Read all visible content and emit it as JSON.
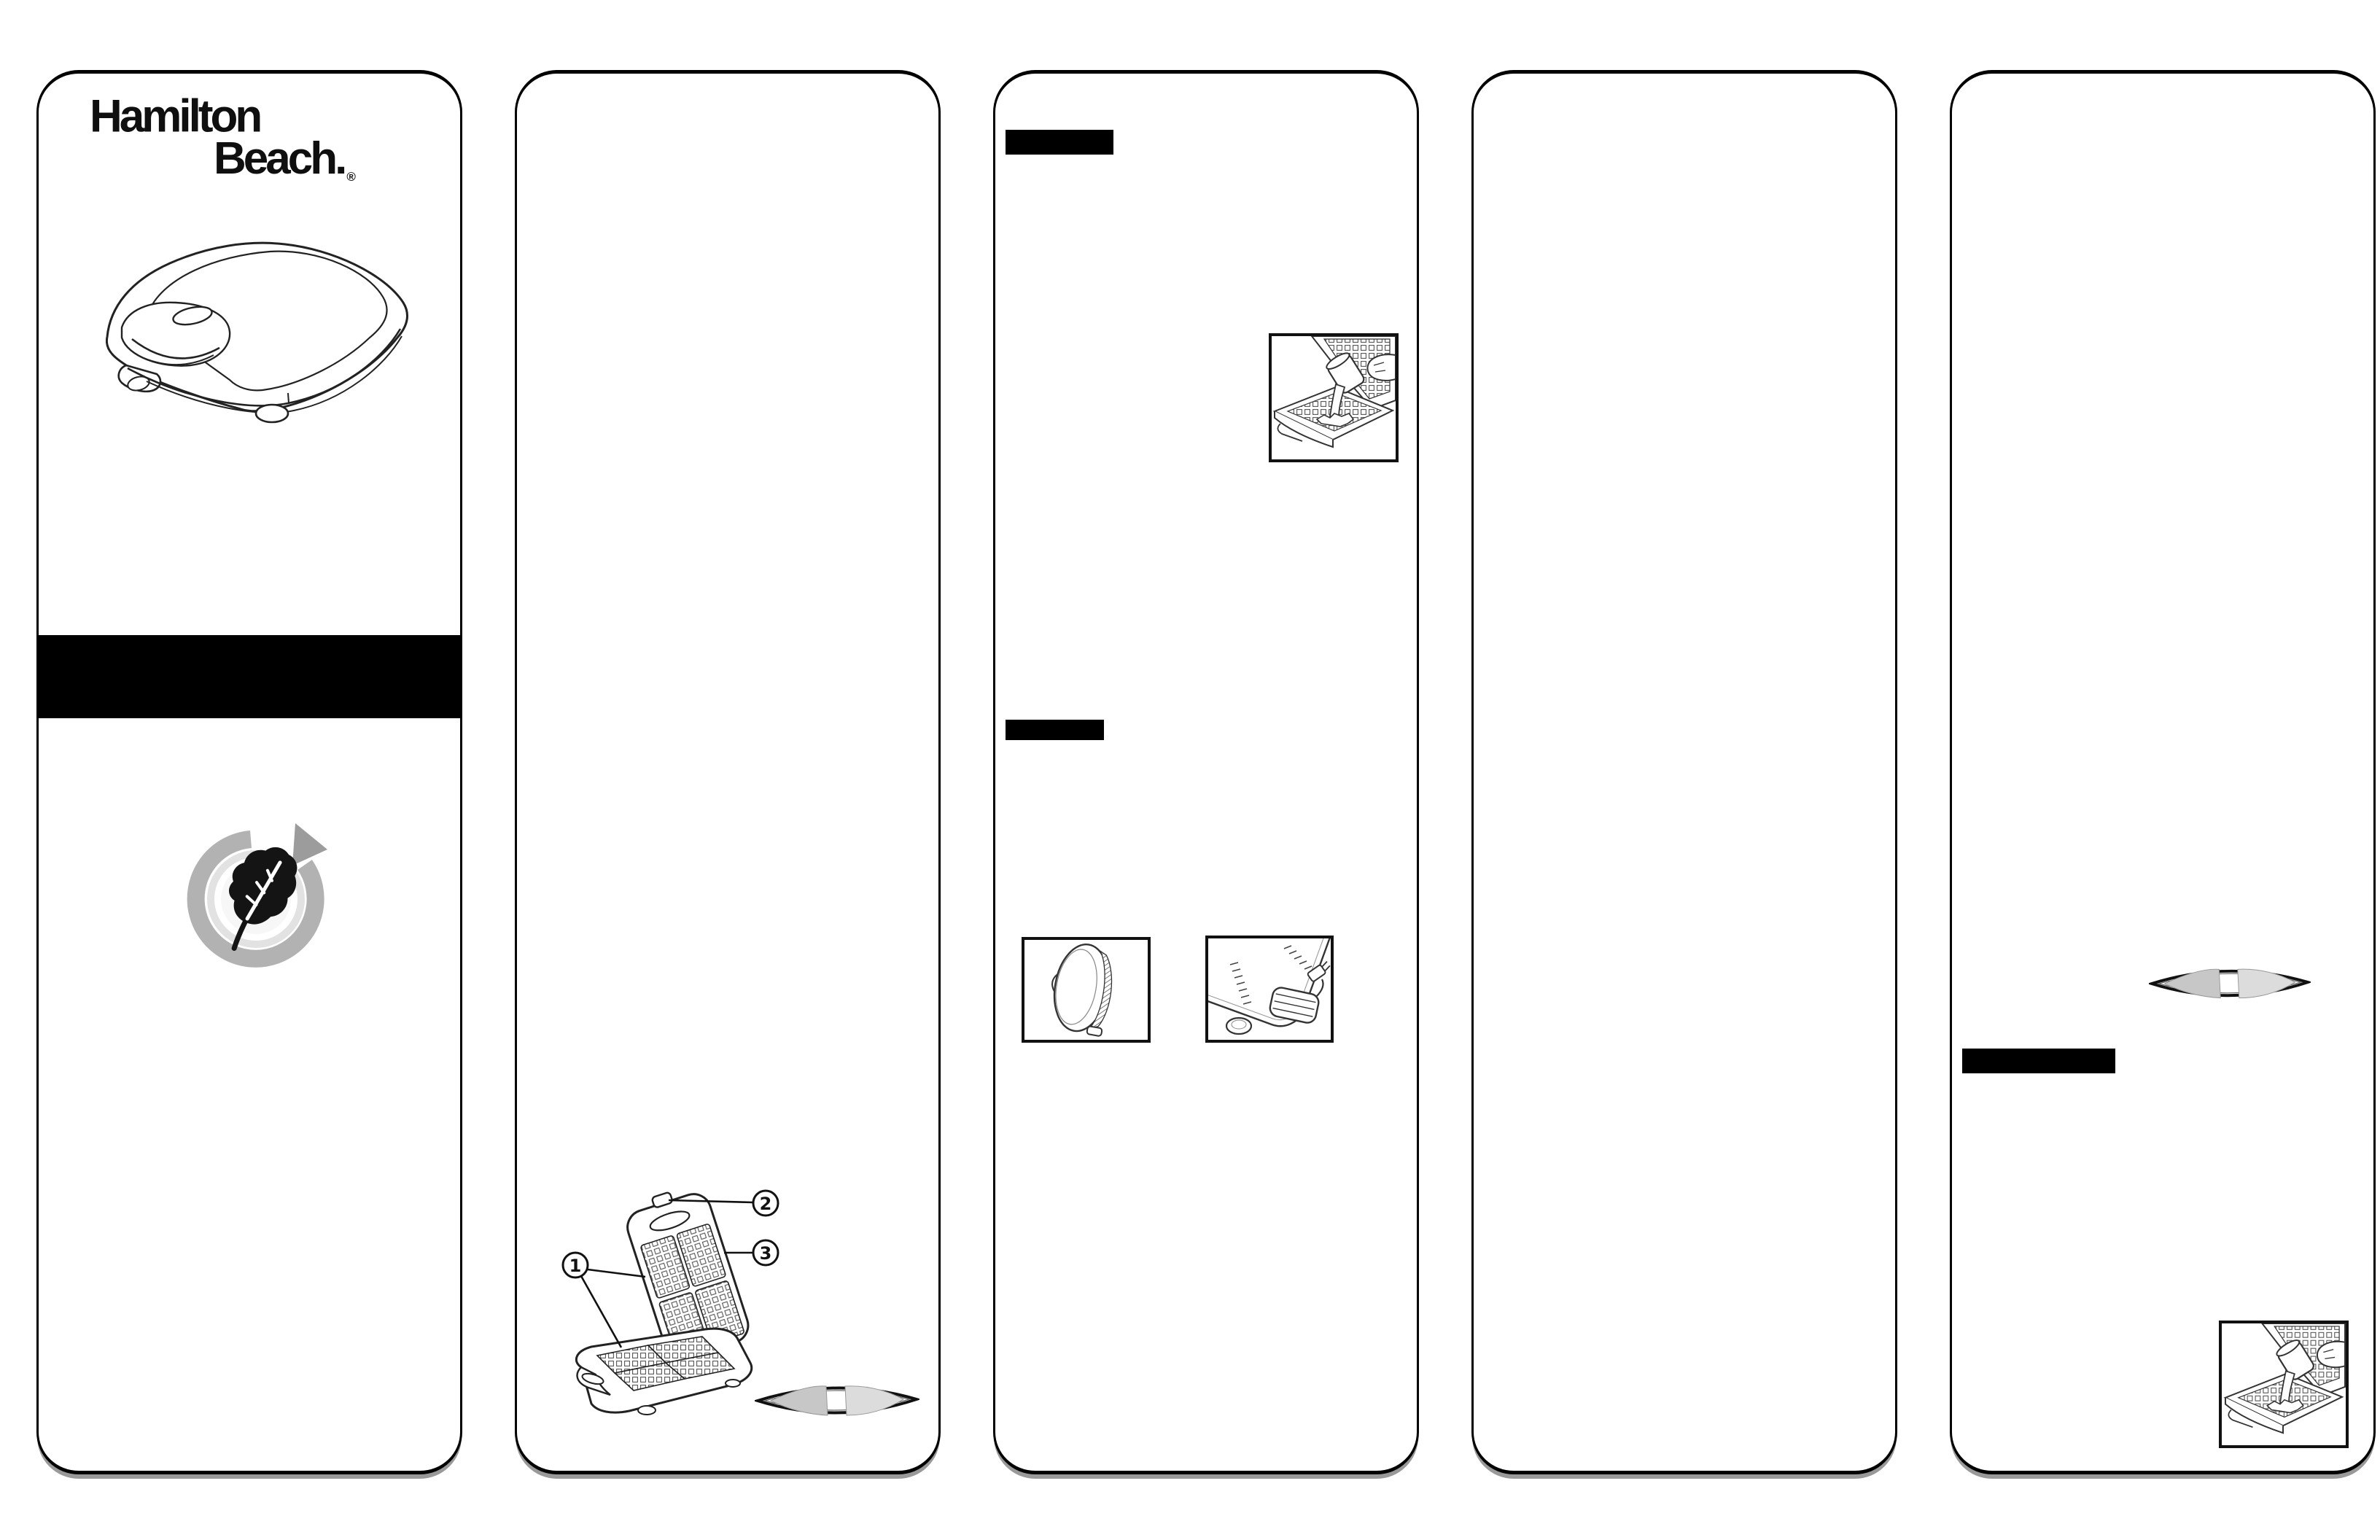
{
  "document": {
    "kind": "scanned appliance manual foldout, 5 panels",
    "background": "#ffffff",
    "panel_count": 5
  },
  "brand": {
    "line1": "Hamilton",
    "line2": "Beach.",
    "registered_mark": "®"
  },
  "parts_diagram": {
    "callouts": {
      "one": "1",
      "two": "2",
      "three": "3"
    }
  },
  "figures": {
    "panel1": [
      "hamilton-beach-logo",
      "closed-waffle-maker-illustration",
      "redacted-black-band",
      "eco-leaf-recycle-badge"
    ],
    "panel2": [
      "open-waffle-maker-parts-diagram",
      "waffle-quarter-plate-shape"
    ],
    "panel3": [
      "redacted-heading-bar",
      "pour-batter-figure",
      "redacted-heading-bar",
      "upright-storage-figure",
      "cord-wrap-figure"
    ],
    "panel4": [],
    "panel5": [
      "waffle-quarter-plate-shape",
      "redacted-heading-bar",
      "pour-batter-figure"
    ]
  },
  "colors": {
    "panel_border": "#000000",
    "redaction_bar": "#000000",
    "line_art_ink": "#222222",
    "recycle_ring_gray": "#b2b2b2",
    "recycle_arrow_gray": "#9c9c9c",
    "leaf_black": "#141414",
    "waffle_half_dark": "#c7c7c7",
    "waffle_half_light": "#dcdcdc"
  }
}
